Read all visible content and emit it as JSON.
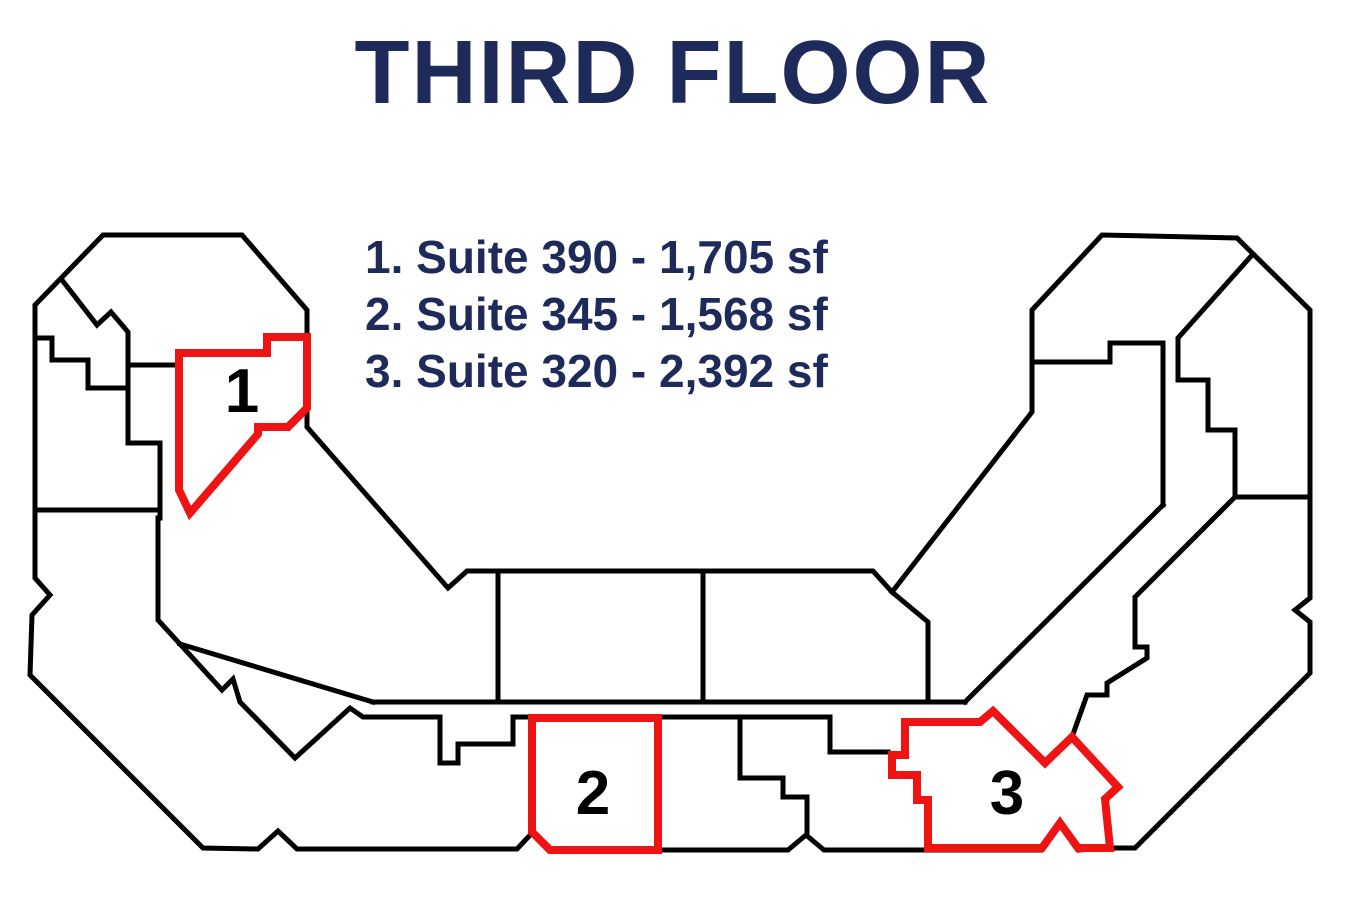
{
  "title": "THIRD FLOOR",
  "legend": {
    "items": [
      {
        "text": "1. Suite 390 - 1,705 sf"
      },
      {
        "text": "2. Suite 345 - 1,568 sf"
      },
      {
        "text": "3. Suite 320 - 2,392 sf"
      }
    ]
  },
  "suites": [
    {
      "label": "1",
      "name": "Suite 390",
      "area": "1,705 sf"
    },
    {
      "label": "2",
      "name": "Suite 345",
      "area": "1,568 sf"
    },
    {
      "label": "3",
      "name": "Suite 320",
      "area": "2,392 sf"
    }
  ],
  "colors": {
    "title_text": "#1e2b5a",
    "suite_highlight": "#ee1414",
    "walls": "#000000",
    "background": "#ffffff"
  },
  "floorplan": {
    "outline": [
      [
        103,
        235
      ],
      [
        242,
        235
      ],
      [
        307,
        310
      ],
      [
        307,
        427
      ],
      [
        448,
        588
      ],
      [
        467,
        571
      ],
      [
        873,
        571
      ],
      [
        892,
        592
      ],
      [
        1032,
        412
      ],
      [
        1032,
        310
      ],
      [
        1102,
        235
      ],
      [
        1237,
        238
      ],
      [
        1310,
        310
      ],
      [
        1310,
        598
      ],
      [
        1295,
        610
      ],
      [
        1310,
        622
      ],
      [
        1310,
        673
      ],
      [
        1135,
        848
      ],
      [
        1110,
        848
      ],
      [
        1078,
        850
      ],
      [
        1060,
        824
      ],
      [
        1042,
        850
      ],
      [
        928,
        850
      ],
      [
        824,
        850
      ],
      [
        806,
        835
      ],
      [
        788,
        850
      ],
      [
        658,
        850
      ],
      [
        550,
        850
      ],
      [
        532,
        833
      ],
      [
        517,
        849
      ],
      [
        297,
        849
      ],
      [
        278,
        831
      ],
      [
        258,
        849
      ],
      [
        203,
        848
      ],
      [
        30,
        675
      ],
      [
        32,
        615
      ],
      [
        50,
        595
      ],
      [
        35,
        578
      ],
      [
        35,
        305
      ]
    ],
    "partitions": [
      [
        [
          62,
          280
        ],
        [
          97,
          325
        ],
        [
          111,
          312
        ],
        [
          128,
          332
        ],
        [
          128,
          443
        ],
        [
          160,
          443
        ],
        [
          160,
          518
        ]
      ],
      [
        [
          35,
          338
        ],
        [
          52,
          338
        ],
        [
          52,
          360
        ],
        [
          88,
          360
        ],
        [
          88,
          388
        ],
        [
          128,
          388
        ]
      ],
      [
        [
          35,
          510
        ],
        [
          160,
          510
        ]
      ],
      [
        [
          128,
          365
        ],
        [
          179,
          365
        ]
      ],
      [
        [
          158,
          518
        ],
        [
          158,
          620
        ],
        [
          222,
          690
        ],
        [
          233,
          679
        ],
        [
          240,
          702
        ],
        [
          295,
          758
        ],
        [
          350,
          708
        ],
        [
          363,
          717
        ],
        [
          440,
          717
        ],
        [
          440,
          763
        ],
        [
          458,
          763
        ],
        [
          458,
          744
        ],
        [
          513,
          744
        ],
        [
          513,
          717
        ],
        [
          532,
          717
        ]
      ],
      [
        [
          180,
          644
        ],
        [
          373,
          702
        ]
      ],
      [
        [
          373,
          702
        ],
        [
          965,
          702
        ]
      ],
      [
        [
          498,
          572
        ],
        [
          498,
          701
        ]
      ],
      [
        [
          703,
          572
        ],
        [
          703,
          701
        ]
      ],
      [
        [
          892,
          592
        ],
        [
          928,
          622
        ],
        [
          928,
          701
        ]
      ],
      [
        [
          658,
          717
        ],
        [
          830,
          717
        ],
        [
          830,
          752
        ],
        [
          888,
          752
        ]
      ],
      [
        [
          740,
          717
        ],
        [
          740,
          778
        ],
        [
          783,
          778
        ],
        [
          783,
          797
        ],
        [
          807,
          797
        ],
        [
          807,
          835
        ]
      ],
      [
        [
          965,
          702
        ],
        [
          1163,
          505
        ]
      ],
      [
        [
          1163,
          343
        ],
        [
          1163,
          505
        ]
      ],
      [
        [
          1032,
          362
        ],
        [
          1110,
          362
        ],
        [
          1110,
          343
        ],
        [
          1163,
          343
        ]
      ],
      [
        [
          1253,
          254
        ],
        [
          1178,
          338
        ],
        [
          1178,
          380
        ],
        [
          1208,
          380
        ],
        [
          1208,
          430
        ],
        [
          1235,
          430
        ],
        [
          1235,
          497
        ],
        [
          1310,
          497
        ]
      ],
      [
        [
          1235,
          497
        ],
        [
          1135,
          597
        ],
        [
          1135,
          647
        ],
        [
          1147,
          647
        ],
        [
          1147,
          658
        ],
        [
          1107,
          683
        ],
        [
          1107,
          695
        ],
        [
          1087,
          695
        ],
        [
          1072,
          737
        ]
      ]
    ],
    "suite_boundaries": [
      [
        [
          179,
          353
        ],
        [
          267,
          353
        ],
        [
          267,
          337
        ],
        [
          307,
          337
        ],
        [
          307,
          408
        ],
        [
          288,
          427
        ],
        [
          258,
          427
        ],
        [
          258,
          434
        ],
        [
          190,
          513
        ],
        [
          179,
          490
        ]
      ],
      [
        [
          532,
          718
        ],
        [
          658,
          718
        ],
        [
          658,
          850
        ],
        [
          550,
          850
        ],
        [
          532,
          832
        ]
      ],
      [
        [
          905,
          722
        ],
        [
          980,
          722
        ],
        [
          993,
          711
        ],
        [
          1045,
          763
        ],
        [
          1072,
          737
        ],
        [
          1118,
          787
        ],
        [
          1105,
          799
        ],
        [
          1110,
          848
        ],
        [
          1078,
          848
        ],
        [
          1060,
          823
        ],
        [
          1042,
          848
        ],
        [
          928,
          848
        ],
        [
          928,
          800
        ],
        [
          917,
          800
        ],
        [
          917,
          775
        ],
        [
          892,
          775
        ],
        [
          892,
          755
        ],
        [
          905,
          755
        ]
      ]
    ]
  }
}
